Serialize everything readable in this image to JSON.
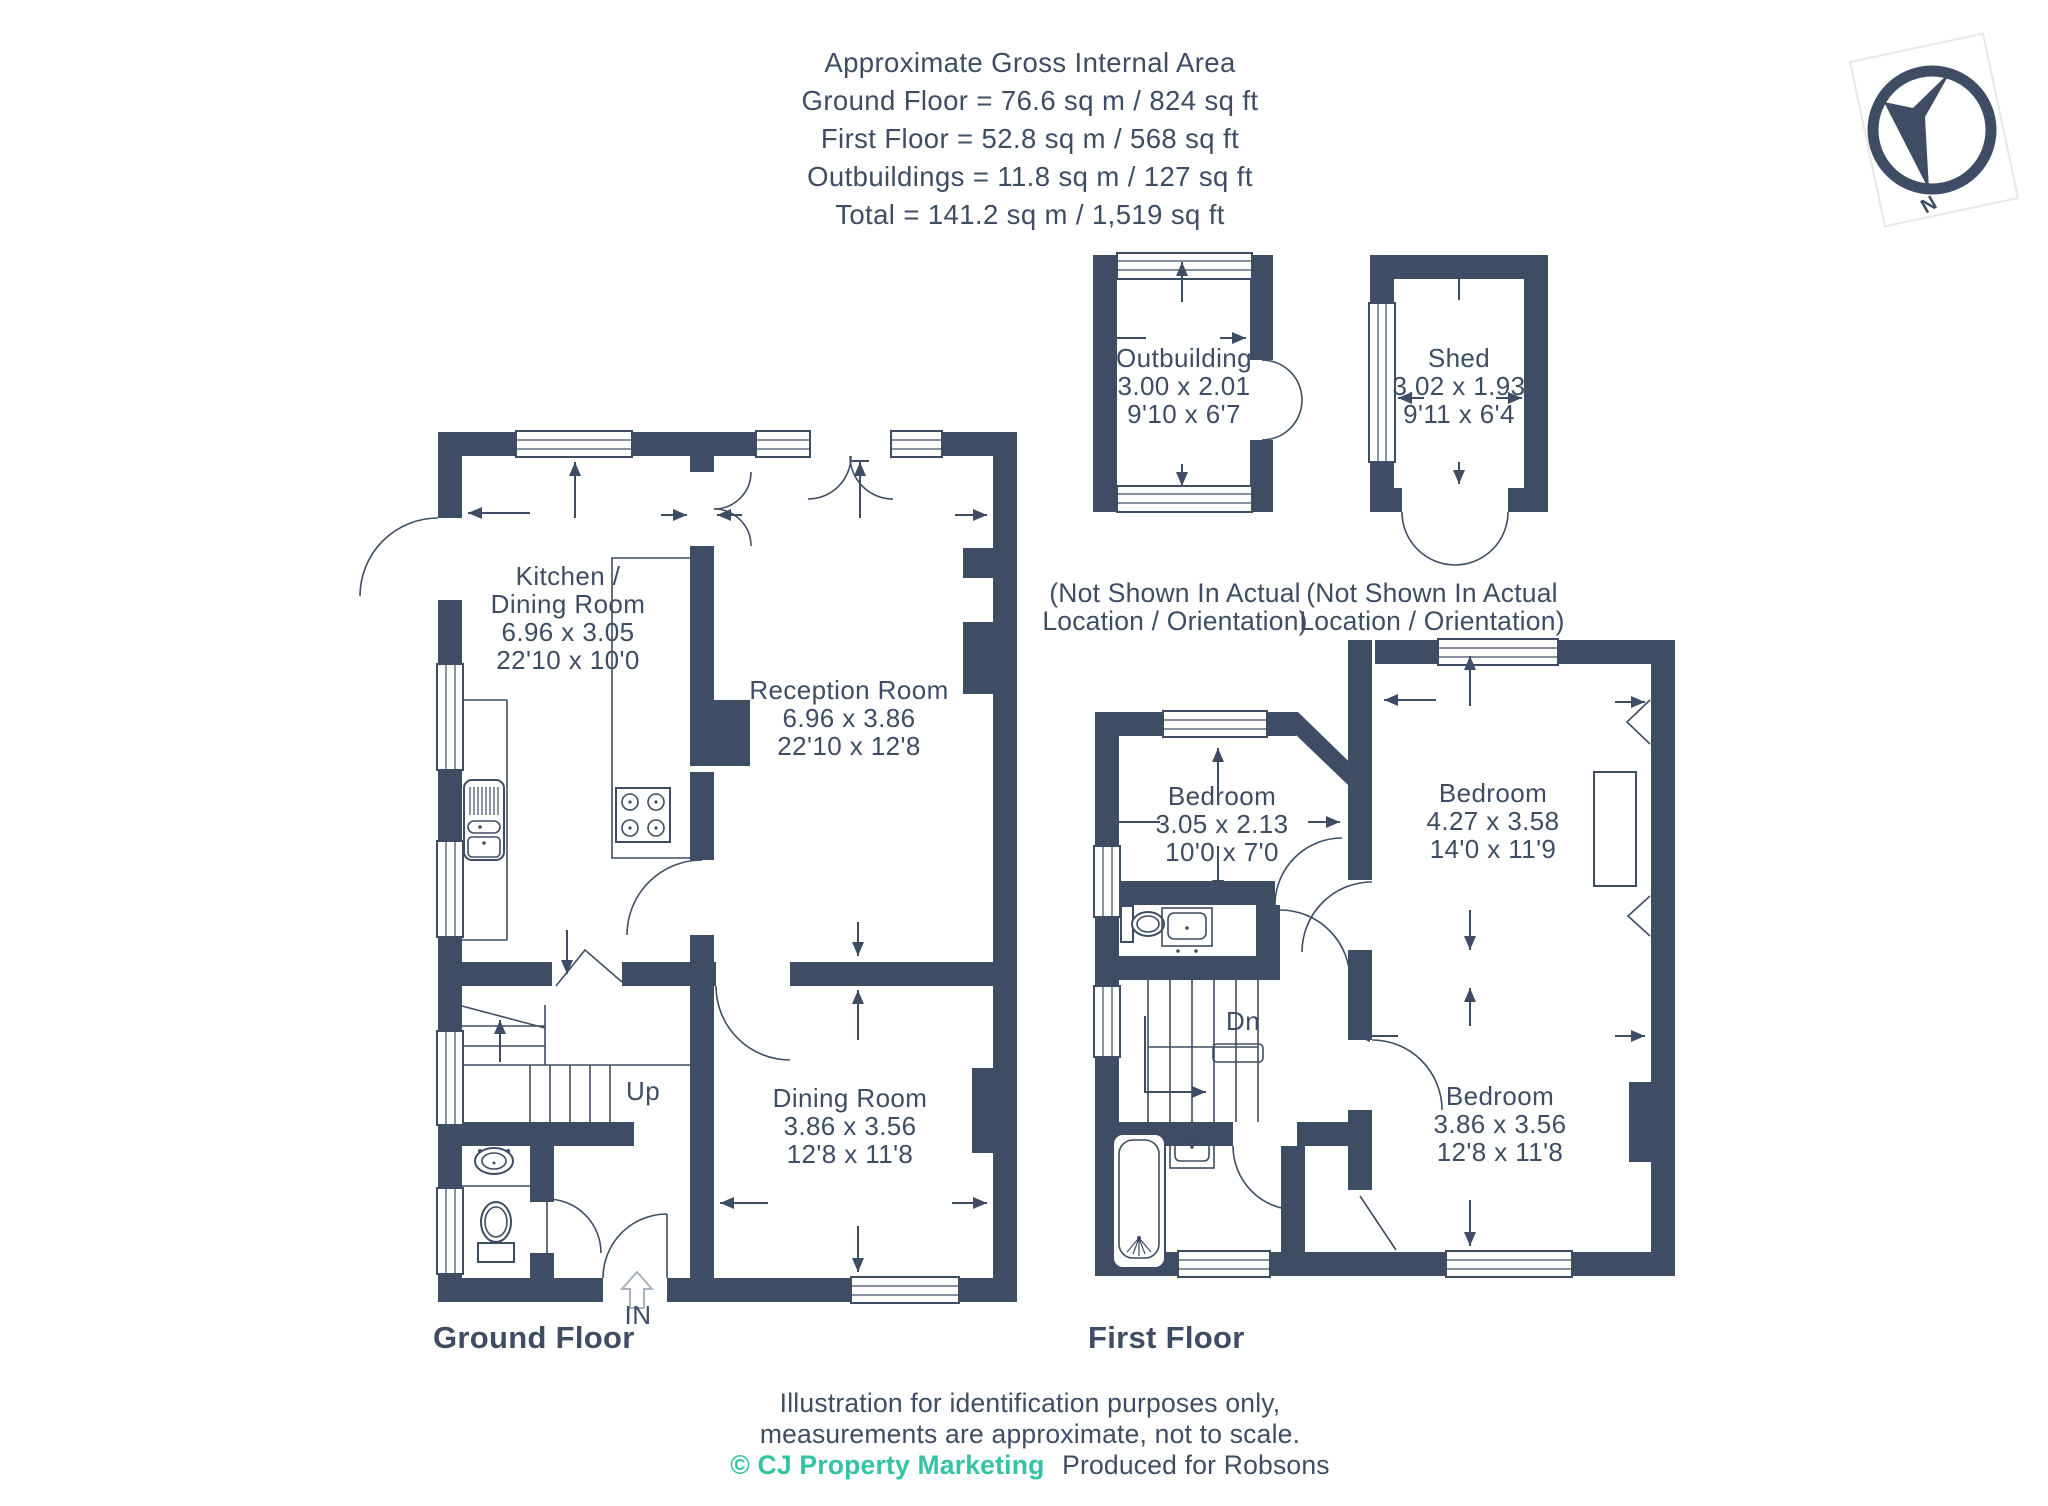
{
  "header": {
    "lines": [
      "Approximate Gross Internal Area",
      "Ground Floor = 76.6 sq m / 824 sq ft",
      "First Floor = 52.8 sq m / 568 sq ft",
      "Outbuildings = 11.8 sq m / 127 sq ft",
      "Total = 141.2 sq m / 1,519 sq ft"
    ]
  },
  "compass": {
    "north": "N"
  },
  "colors": {
    "wall": "#3e4d63",
    "accent_teal": "#35c4a2"
  },
  "ground_floor": {
    "title": "Ground Floor",
    "in_label": "IN",
    "up_label": "Up",
    "rooms": {
      "kitchen_dining": {
        "lines": [
          "Kitchen /",
          "Dining Room",
          "6.96 x 3.05",
          "22'10 x 10'0"
        ]
      },
      "reception": {
        "lines": [
          "Reception Room",
          "6.96 x 3.86",
          "22'10 x 12'8"
        ]
      },
      "dining": {
        "lines": [
          "Dining Room",
          "3.86 x 3.56",
          "12'8 x 11'8"
        ]
      }
    }
  },
  "first_floor": {
    "title": "First Floor",
    "dn_label": "Dn",
    "rooms": {
      "bedroom_front": {
        "lines": [
          "Bedroom",
          "3.05 x 2.13",
          "10'0 x 7'0"
        ]
      },
      "bedroom_main": {
        "lines": [
          "Bedroom",
          "4.27 x 3.58",
          "14'0 x 11'9"
        ]
      },
      "bedroom_rear": {
        "lines": [
          "Bedroom",
          "3.86 x 3.56",
          "12'8 x 11'8"
        ]
      }
    }
  },
  "outbuildings": {
    "outbuilding": {
      "lines": [
        "Outbuilding",
        "3.00 x 2.01",
        "9'10 x 6'7"
      ],
      "note": [
        "(Not Shown In Actual",
        "Location / Orientation)"
      ]
    },
    "shed": {
      "lines": [
        "Shed",
        "3.02 x 1.93",
        "9'11 x 6'4"
      ],
      "note": [
        "(Not Shown In Actual",
        "Location / Orientation)"
      ]
    }
  },
  "footer": {
    "line1": "Illustration for identification purposes only,",
    "line2": "measurements are approximate, not to scale.",
    "copyright": "© CJ Property Marketing",
    "produced": "Produced for Robsons"
  }
}
